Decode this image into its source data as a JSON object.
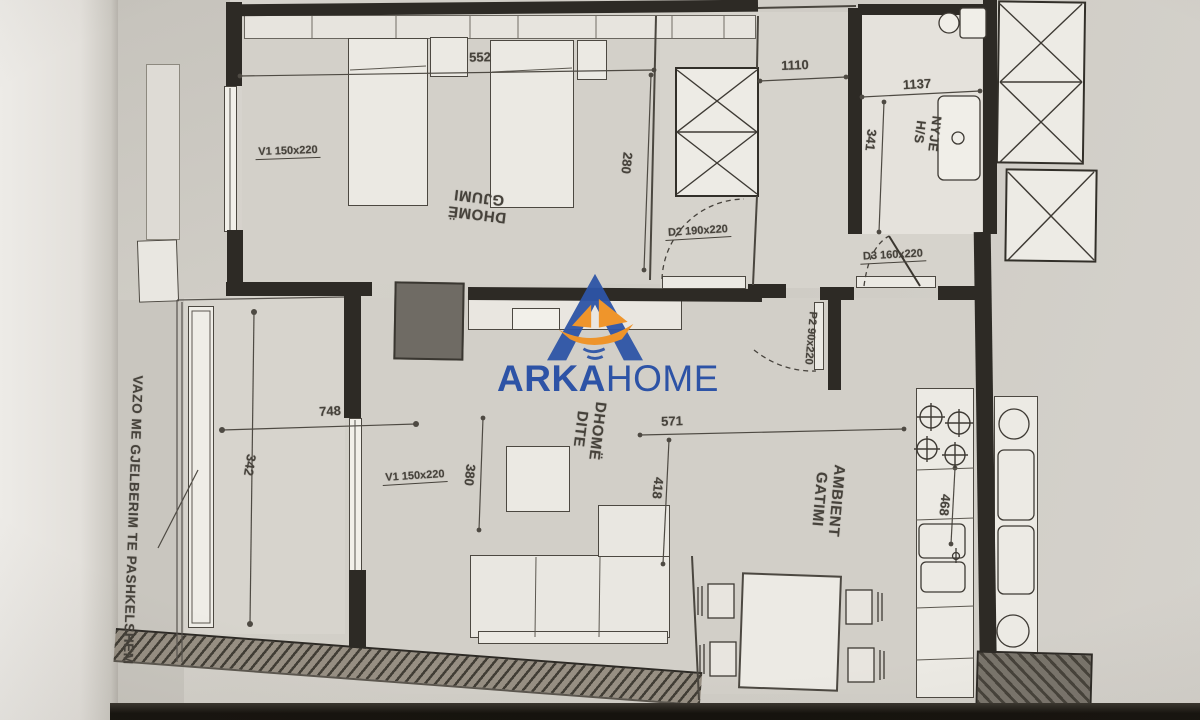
{
  "logo": {
    "arka": "ARKA",
    "home": "HOME"
  },
  "rooms": {
    "bedroom": {
      "l1": "DHOMË",
      "l2": "GJUMI"
    },
    "living": {
      "l1": "DHOMË",
      "l2": "DITE"
    },
    "kitchen": {
      "l1": "AMBIENT",
      "l2": "GATIMI"
    },
    "bath": {
      "l1": "NYJE",
      "l2": "H/S"
    }
  },
  "dims": {
    "d552": "552",
    "d280": "280",
    "d1110": "1110",
    "d1137": "1137",
    "d341": "341",
    "d748": "748",
    "d342": "342",
    "d380": "380",
    "d571": "571",
    "d418": "418",
    "d468": "468"
  },
  "openings": {
    "v1a": "V1   150x220",
    "v1b": "V1   150x220",
    "d2": "D2   190x220",
    "d3": "D3   160x220",
    "p2": "P2  90x220"
  },
  "annotation": {
    "planter": "VAZO ME GJELBERIM TE PASHKELSHEM"
  }
}
